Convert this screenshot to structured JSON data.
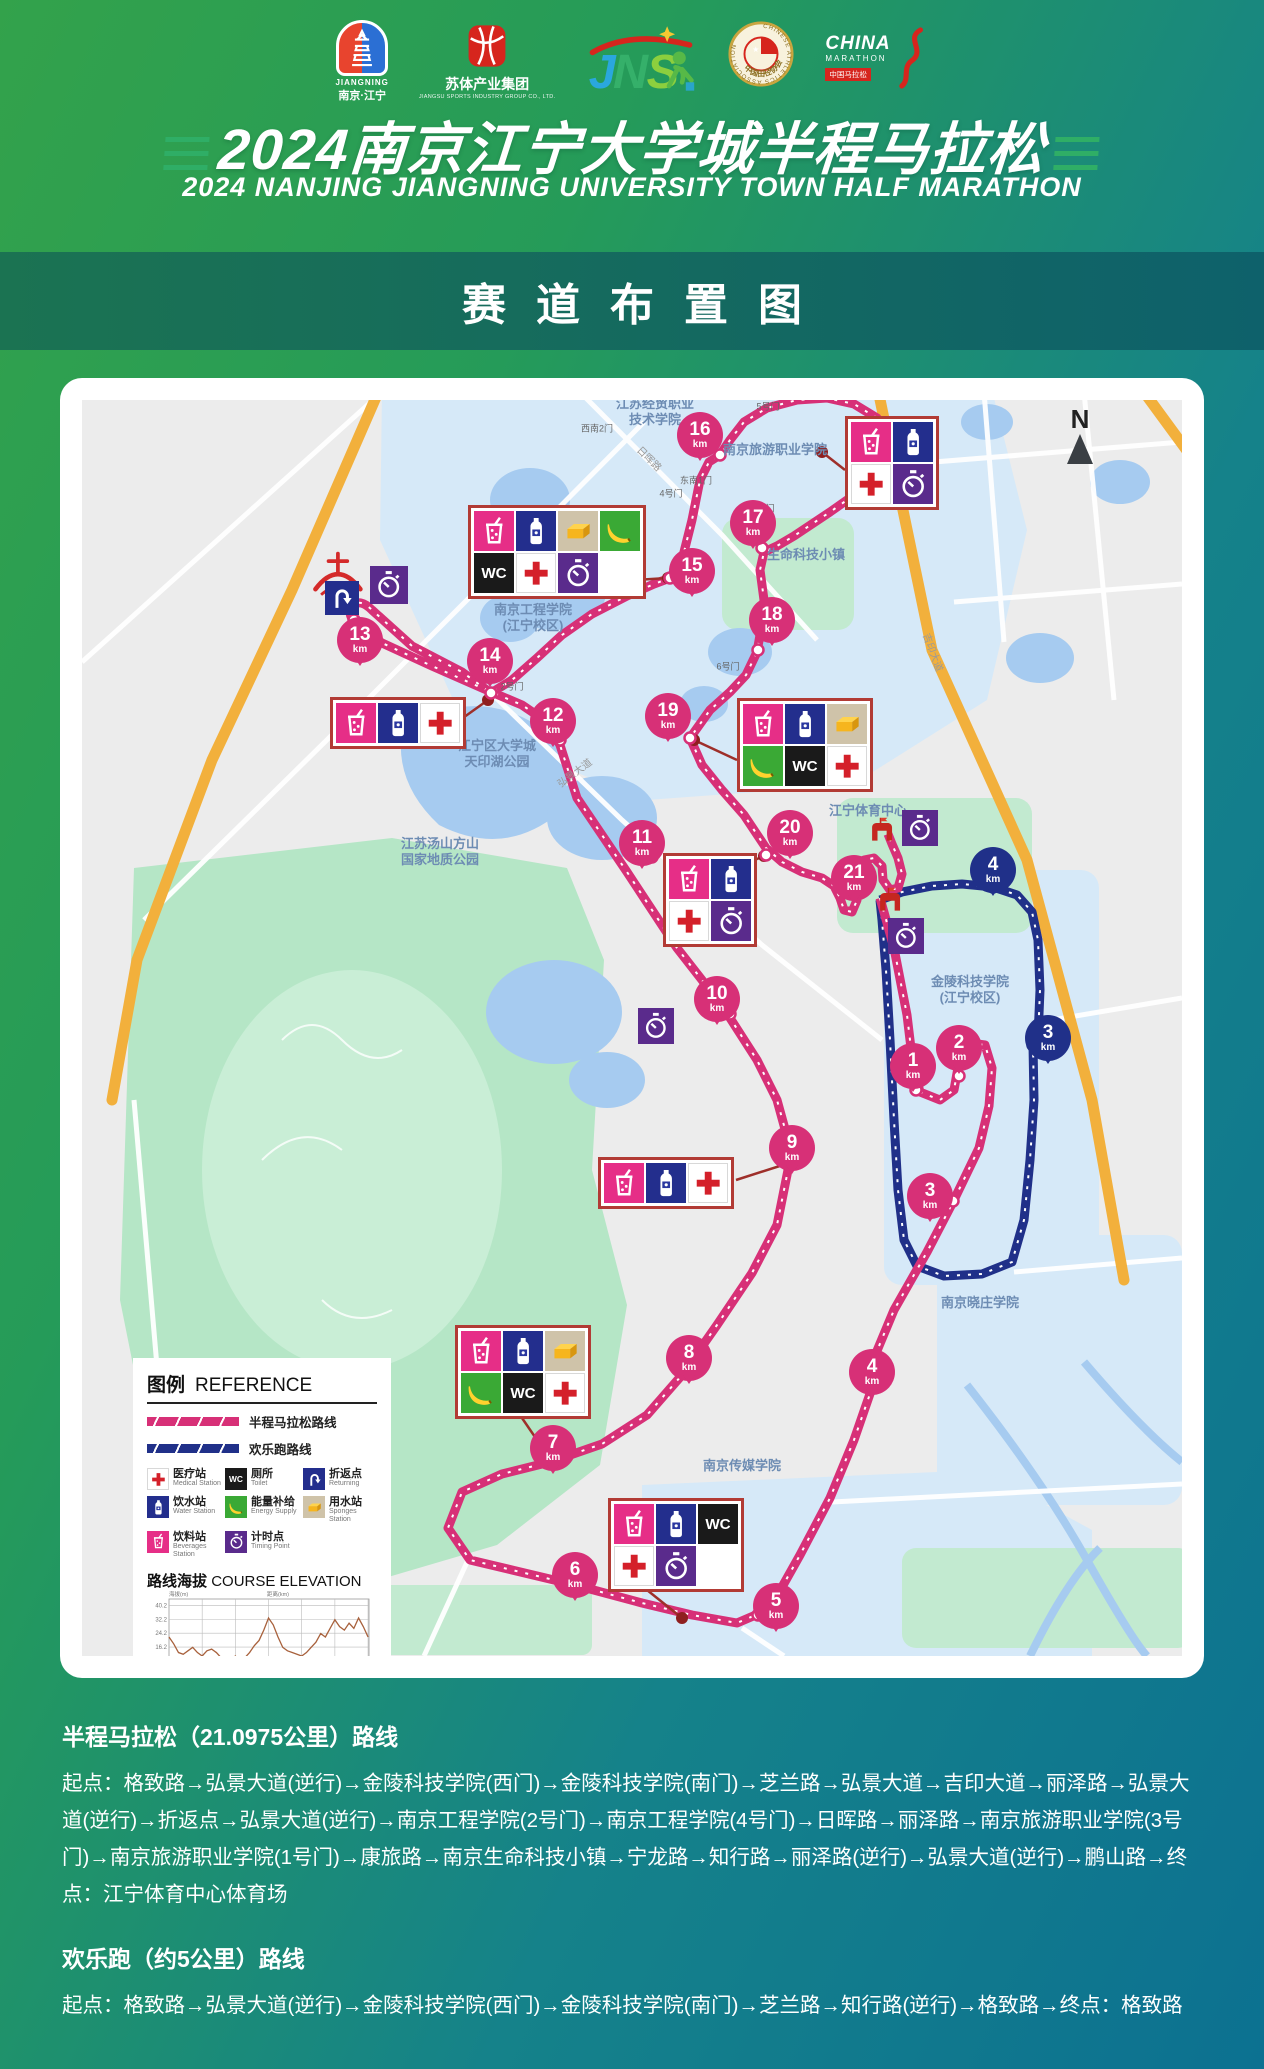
{
  "colors": {
    "route_half": "#d73077",
    "route_fun": "#203089",
    "orange_road": "#f2b03c",
    "park": "#b5e6c6",
    "water": "#a6cbf0",
    "campus": "#d6e9f8",
    "box_border": "#b23b35",
    "leader": "#9e2f2a"
  },
  "header": {
    "title_zh": "2024南京江宁大学城半程马拉松",
    "title_en": "2024 NANJING JIANGNING UNIVERSITY TOWN HALF MARATHON",
    "band_title": "赛道布置图",
    "logos": {
      "jiangning": {
        "en": "JIANGNING",
        "zh": "南京·江宁"
      },
      "sutisports": {
        "zh": "苏体产业集团",
        "en": "JIANGSU SPORTS INDUSTRY GROUP CO., LTD."
      },
      "caa": {
        "en": "CHINESE ATHLETICS ASSOCIATION",
        "zh": "中国田径协会"
      },
      "china_marathon": {
        "l1": "CHINA",
        "l2": "MARATHON",
        "l3": "中国马拉松"
      }
    }
  },
  "map": {
    "north_label": "N",
    "wc_text": "WC",
    "unit": "km",
    "markers": [
      {
        "v": "16",
        "x": 618,
        "y": 35,
        "dx": 638,
        "dy": 55,
        "c": "half"
      },
      {
        "v": "17",
        "x": 671,
        "y": 123,
        "dx": 680,
        "dy": 148,
        "c": "half"
      },
      {
        "v": "15",
        "x": 610,
        "y": 171,
        "dx": 588,
        "dy": 178,
        "c": "half"
      },
      {
        "v": "18",
        "x": 690,
        "y": 220,
        "dx": 676,
        "dy": 250,
        "c": "half"
      },
      {
        "v": "13",
        "x": 278,
        "y": 240,
        "dx": 272,
        "dy": 220,
        "c": "half"
      },
      {
        "v": "14",
        "x": 408,
        "y": 261,
        "dx": 409,
        "dy": 293,
        "c": "half"
      },
      {
        "v": "12",
        "x": 471,
        "y": 321,
        "dx": 478,
        "dy": 340,
        "c": "half"
      },
      {
        "v": "19",
        "x": 586,
        "y": 316,
        "dx": 608,
        "dy": 338,
        "c": "half"
      },
      {
        "v": "20",
        "x": 708,
        "y": 433,
        "dx": 684,
        "dy": 455,
        "c": "half"
      },
      {
        "v": "11",
        "x": 560,
        "y": 443,
        "dx": 570,
        "dy": 457,
        "c": "half"
      },
      {
        "v": "21",
        "x": 772,
        "y": 478,
        "dx": 780,
        "dy": 468,
        "c": "half"
      },
      {
        "v": "4",
        "x": 911,
        "y": 470,
        "dx": 911,
        "dy": 487,
        "c": "fun"
      },
      {
        "v": "10",
        "x": 635,
        "y": 599,
        "dx": 648,
        "dy": 614,
        "c": "half"
      },
      {
        "v": "3",
        "x": 966,
        "y": 638,
        "dx": 951,
        "dy": 645,
        "c": "fun"
      },
      {
        "v": "2",
        "x": 877,
        "y": 648,
        "dx": 877,
        "dy": 676,
        "c": "half"
      },
      {
        "v": "1",
        "x": 831,
        "y": 666,
        "dx": 834,
        "dy": 690,
        "c": "half"
      },
      {
        "v": "9",
        "x": 710,
        "y": 748,
        "dx": 706,
        "dy": 764,
        "c": "half"
      },
      {
        "v": "3",
        "x": 848,
        "y": 796,
        "dx": 871,
        "dy": 801,
        "c": "half"
      },
      {
        "v": "4",
        "x": 790,
        "y": 972,
        "dx": 790,
        "dy": 988,
        "c": "half"
      },
      {
        "v": "8",
        "x": 607,
        "y": 958,
        "dx": 607,
        "dy": 970,
        "c": "half"
      },
      {
        "v": "7",
        "x": 471,
        "y": 1048,
        "dx": 468,
        "dy": 1062,
        "c": "half"
      },
      {
        "v": "6",
        "x": 493,
        "y": 1175,
        "dx": 493,
        "dy": 1186,
        "c": "half"
      },
      {
        "v": "5",
        "x": 694,
        "y": 1206,
        "dx": 676,
        "dy": 1215,
        "c": "half"
      }
    ],
    "stations": [
      {
        "x": 386,
        "y": 105,
        "cols": 4,
        "icons": [
          "beverage",
          "water",
          "sponge",
          "energy",
          "toilet",
          "medical",
          "timing",
          "empty"
        ],
        "leader": [
          552,
          180,
          586,
          178
        ]
      },
      {
        "x": 763,
        "y": 16,
        "cols": 2,
        "icons": [
          "beverage",
          "water",
          "medical",
          "timing"
        ],
        "leader": [
          763,
          70,
          740,
          52
        ]
      },
      {
        "x": 248,
        "y": 297,
        "cols": 3,
        "icons": [
          "beverage",
          "water",
          "medical"
        ],
        "leader": [
          378,
          320,
          406,
          300
        ]
      },
      {
        "x": 655,
        "y": 298,
        "cols": 3,
        "icons": [
          "beverage",
          "water",
          "sponge",
          "energy",
          "toilet",
          "medical"
        ],
        "leader": [
          655,
          360,
          612,
          340
        ]
      },
      {
        "x": 581,
        "y": 453,
        "cols": 2,
        "icons": [
          "beverage",
          "water",
          "medical",
          "timing"
        ],
        "leader": [
          668,
          462,
          682,
          456
        ]
      },
      {
        "x": 516,
        "y": 757,
        "cols": 3,
        "icons": [
          "beverage",
          "water",
          "medical"
        ],
        "leader": [
          654,
          780,
          704,
          764
        ]
      },
      {
        "x": 373,
        "y": 925,
        "cols": 3,
        "icons": [
          "beverage",
          "water",
          "sponge",
          "energy",
          "toilet",
          "medical"
        ],
        "leader": [
          440,
          1018,
          466,
          1056
        ]
      },
      {
        "x": 526,
        "y": 1098,
        "cols": 3,
        "icons": [
          "beverage",
          "water",
          "toilet",
          "medical",
          "timing",
          "empty"
        ],
        "leader": [
          560,
          1186,
          600,
          1218
        ]
      }
    ],
    "labels": [
      {
        "t": "江苏经贸职业\n技术学院",
        "x": 573,
        "y": 12
      },
      {
        "t": "南京旅游职业学院",
        "x": 693,
        "y": 50
      },
      {
        "t": "生命科技小镇",
        "x": 724,
        "y": 155
      },
      {
        "t": "南京工程学院\n(江宁校区)",
        "x": 451,
        "y": 218
      },
      {
        "t": "江宁区大学城\n天印湖公园",
        "x": 415,
        "y": 354
      },
      {
        "t": "江苏汤山方山\n国家地质公园",
        "x": 358,
        "y": 452
      },
      {
        "t": "江宁体育中心",
        "x": 786,
        "y": 411
      },
      {
        "t": "金陵科技学院\n(江宁校区)",
        "x": 888,
        "y": 590
      },
      {
        "t": "南京晓庄学院",
        "x": 898,
        "y": 903
      },
      {
        "t": "南京传媒学院",
        "x": 660,
        "y": 1066
      }
    ],
    "gates": [
      {
        "t": "5号门",
        "x": 686,
        "y": 6
      },
      {
        "t": "西南2门",
        "x": 515,
        "y": 28
      },
      {
        "t": "东南1门",
        "x": 614,
        "y": 80
      },
      {
        "t": "4号门",
        "x": 589,
        "y": 93
      },
      {
        "t": "1号门",
        "x": 681,
        "y": 108
      },
      {
        "t": "2号门",
        "x": 430,
        "y": 286
      },
      {
        "t": "6号门",
        "x": 646,
        "y": 266
      }
    ],
    "roads": [
      {
        "t": "日晖路",
        "x": 568,
        "y": 58,
        "r": 45
      },
      {
        "t": "弘景大道",
        "x": 492,
        "y": 372,
        "r": -37
      },
      {
        "t": "吉印大道",
        "x": 852,
        "y": 252,
        "r": 70
      }
    ],
    "standalone": [
      {
        "icon": "sports",
        "x": 222,
        "y": 144,
        "s": 68
      },
      {
        "icon": "uturn",
        "x": 243,
        "y": 181,
        "s": 34
      },
      {
        "icon": "timing",
        "x": 288,
        "y": 166,
        "s": 38
      },
      {
        "icon": "timing",
        "x": 820,
        "y": 410,
        "s": 36
      },
      {
        "icon": "timing",
        "x": 806,
        "y": 518,
        "s": 36
      },
      {
        "icon": "timing",
        "x": 556,
        "y": 608,
        "s": 36
      },
      {
        "icon": "gate",
        "x": 784,
        "y": 414,
        "s": 32
      },
      {
        "icon": "gate",
        "x": 792,
        "y": 484,
        "s": 32
      }
    ]
  },
  "legend": {
    "title_zh": "图例",
    "title_en": "REFERENCE",
    "route_samples": [
      {
        "label": "半程马拉松路线",
        "color": "#d73077"
      },
      {
        "label": "欢乐跑路线",
        "color": "#203089"
      }
    ],
    "items": [
      {
        "icon": "medical",
        "zh": "医疗站",
        "en": "Medical Station"
      },
      {
        "icon": "toilet",
        "zh": "厕所",
        "en": "Toilet"
      },
      {
        "icon": "uturn",
        "zh": "折返点",
        "en": "Returning"
      },
      {
        "icon": "water",
        "zh": "饮水站",
        "en": "Water Station"
      },
      {
        "icon": "energy",
        "zh": "能量补给",
        "en": "Energy Supply"
      },
      {
        "icon": "sponge",
        "zh": "用水站",
        "en": "Sponges Station"
      },
      {
        "icon": "beverage",
        "zh": "饮料站",
        "en": "Beverages Station"
      },
      {
        "icon": "timing",
        "zh": "计时点",
        "en": "Timing Point"
      }
    ],
    "elevation_title_zh": "路线海拔",
    "elevation_title_en": "COURSE ELEVATION"
  },
  "chart_data": {
    "type": "line",
    "title": "路线海拔 COURSE ELEVATION",
    "xlabel": "距离(km)",
    "ylabel": "海拔(m)",
    "x_ticks": [
      3.5,
      7.0,
      10.5,
      14.0,
      17.5,
      21.0
    ],
    "y_ticks": [
      8.2,
      16.2,
      24.2,
      32.2,
      40.2
    ],
    "xlim": [
      0,
      21.1
    ],
    "ylim": [
      0,
      44
    ],
    "line_color": "#a8613c",
    "grid": true,
    "x": [
      0,
      0.5,
      1,
      1.5,
      2,
      2.5,
      3,
      3.5,
      4,
      4.5,
      5,
      5.5,
      6,
      6.5,
      7,
      7.5,
      8,
      8.5,
      9,
      9.5,
      10,
      10.5,
      11,
      11.5,
      12,
      12.5,
      13,
      13.5,
      14,
      14.5,
      15,
      15.5,
      16,
      16.5,
      17,
      17.5,
      18,
      18.5,
      19,
      19.5,
      20,
      20.5,
      21
    ],
    "elevation": [
      22,
      18,
      13,
      12,
      14,
      16,
      13,
      11,
      14,
      15,
      13,
      10,
      8,
      9,
      11,
      8,
      10,
      13,
      17,
      20,
      26,
      33,
      29,
      22,
      16,
      14,
      13,
      12,
      11,
      13,
      16,
      19,
      24,
      22,
      27,
      32,
      28,
      26,
      30,
      27,
      33,
      28,
      22
    ]
  },
  "routes_section": {
    "half_heading": "半程马拉松（21.0975公里）路线",
    "half_body": "起点：格致路→弘景大道(逆行)→金陵科技学院(西门)→金陵科技学院(南门)→芝兰路→弘景大道→吉印大道→丽泽路→弘景大道(逆行)→折返点→弘景大道(逆行)→南京工程学院(2号门)→南京工程学院(4号门)→日晖路→丽泽路→南京旅游职业学院(3号门)→南京旅游职业学院(1号门)→康旅路→南京生命科技小镇→宁龙路→知行路→丽泽路(逆行)→弘景大道(逆行)→鹏山路→终点：江宁体育中心体育场",
    "fun_heading": "欢乐跑（约5公里）路线",
    "fun_body": "起点：格致路→弘景大道(逆行)→金陵科技学院(西门)→金陵科技学院(南门)→芝兰路→知行路(逆行)→格致路→终点：格致路"
  }
}
